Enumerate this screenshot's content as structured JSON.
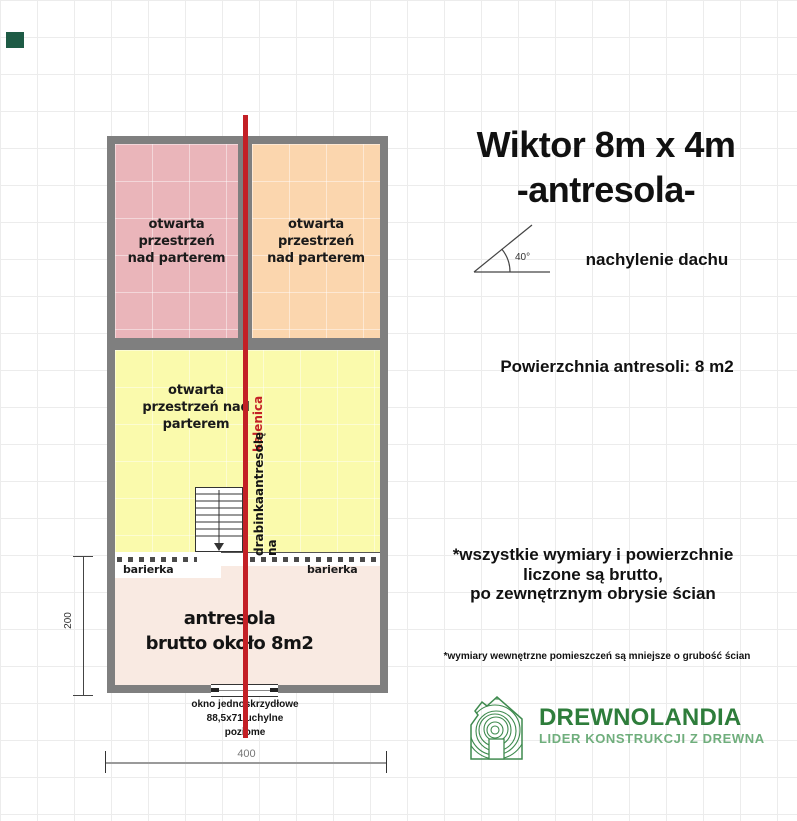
{
  "title": {
    "line1": "Wiktor 8m x 4m",
    "line2": "-antresola-"
  },
  "roof": {
    "angle": "40°",
    "caption": "nachylenie dachu"
  },
  "mezzanine_area_text": "Powierzchnia antresoli: 8 m2",
  "notes": {
    "line1": "*wszystkie wymiary i powierzchnie",
    "line2": "liczone są brutto,",
    "line3": "po zewnętrznym obrysie ścian",
    "footnote": "*wymiary wewnętrzne pomieszczeń są mniejsze o grubość ścian"
  },
  "logo": {
    "name": "DREWNOLANDIA",
    "tagline": "LIDER KONSTRUKCJI Z DREWNA"
  },
  "plan": {
    "room_top_left": "otwarta przestrzeń nad parterem",
    "room_top_right": "otwarta przestrzeń nad parterem",
    "room_middle": "otwarta przestrzeń nad parterem",
    "ridge_label": "kalenica",
    "ladder_label_line1": "drabinka na",
    "ladder_label_line2": "antresolę",
    "barrier_left": "barierka",
    "barrier_right": "barierka",
    "mezzanine_line1": "antresola",
    "mezzanine_line2": "brutto około 8m2",
    "window_line1": "okno jednoskrzydłowe",
    "window_line2": "88,5x71 uchylne",
    "window_line3": "poziome",
    "dim_vertical": "200",
    "dim_horizontal": "400"
  },
  "colors": {
    "wall_gray": "#7f7f7f",
    "room_pink": "#eab5ba",
    "room_peach": "#fbd6ae",
    "room_yellow": "#fafaac",
    "mezzanine_pink": "#f9eae2",
    "ridge_red": "#c32026",
    "logo_green": "#2e7d3b",
    "logo_green_light": "#6fae7c"
  }
}
